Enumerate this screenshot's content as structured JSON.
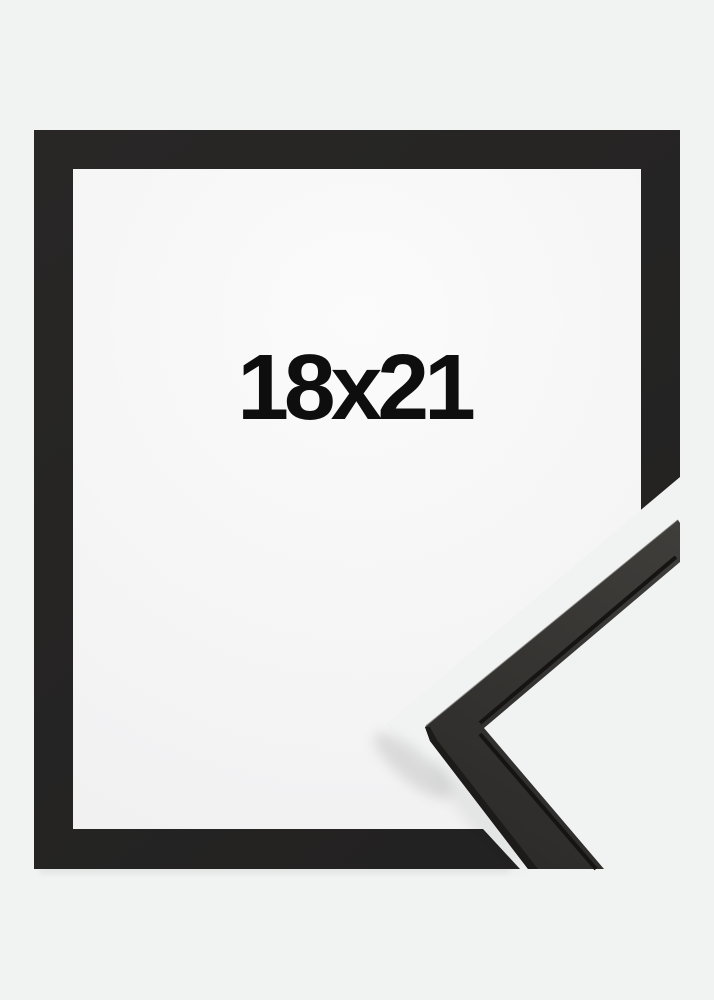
{
  "product_image": {
    "size_label": "18x21",
    "colors": {
      "background": "#f1f2f2",
      "frame_light": "#282726",
      "frame_dark": "#222121",
      "interior_center": "#fbfbfb",
      "interior_edge": "#f1f1f2",
      "moulding_face_light": "#403e3b",
      "moulding_face_dark": "#2c2b29",
      "moulding_groove": "#151413",
      "moulding_side": "#1c1b1a",
      "moulding_highlight": "#4c4945",
      "label_text": "#0e0e0e"
    }
  }
}
